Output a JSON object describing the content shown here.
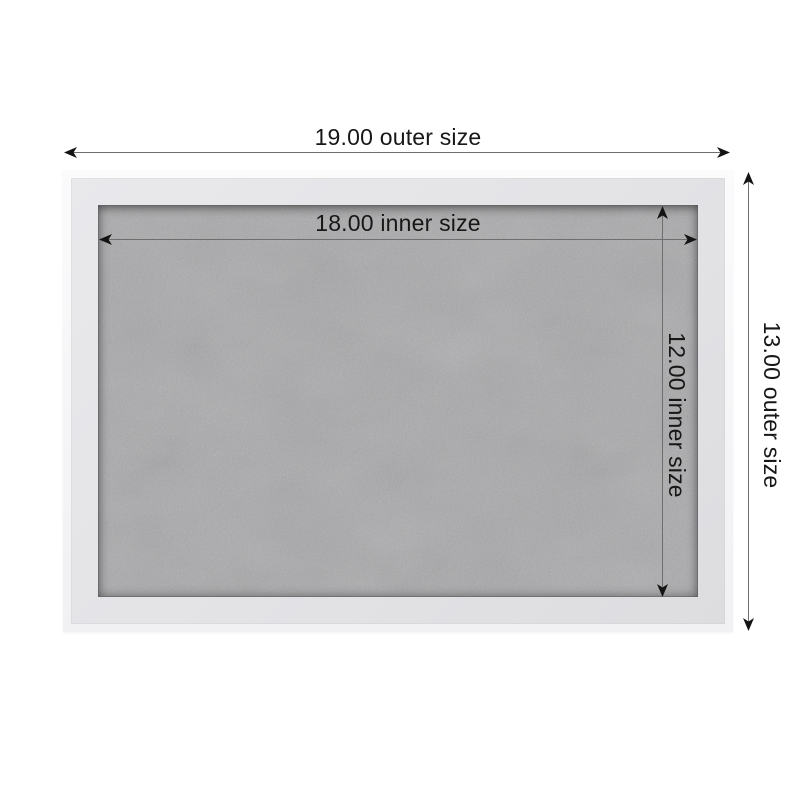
{
  "diagram": {
    "type": "product-dimension-diagram",
    "subject": "framed gray board",
    "dimensions": {
      "outer_width": {
        "value": "19.00",
        "label": "19.00 outer size"
      },
      "outer_height": {
        "value": "13.00",
        "label": "13.00 outer size"
      },
      "inner_width": {
        "value": "18.00",
        "label": "18.00 inner size"
      },
      "inner_height": {
        "value": "12.00",
        "label": "12.00 inner size"
      }
    },
    "colors": {
      "page_background": "#ffffff",
      "frame_outer_edge": "#fafafb",
      "frame_moulding_face": "#e4e4e7",
      "board_surface": "#a9a9ab",
      "dimension_line": "#6e6e6e",
      "arrowhead": "#141414",
      "label_text": "#171717"
    }
  }
}
